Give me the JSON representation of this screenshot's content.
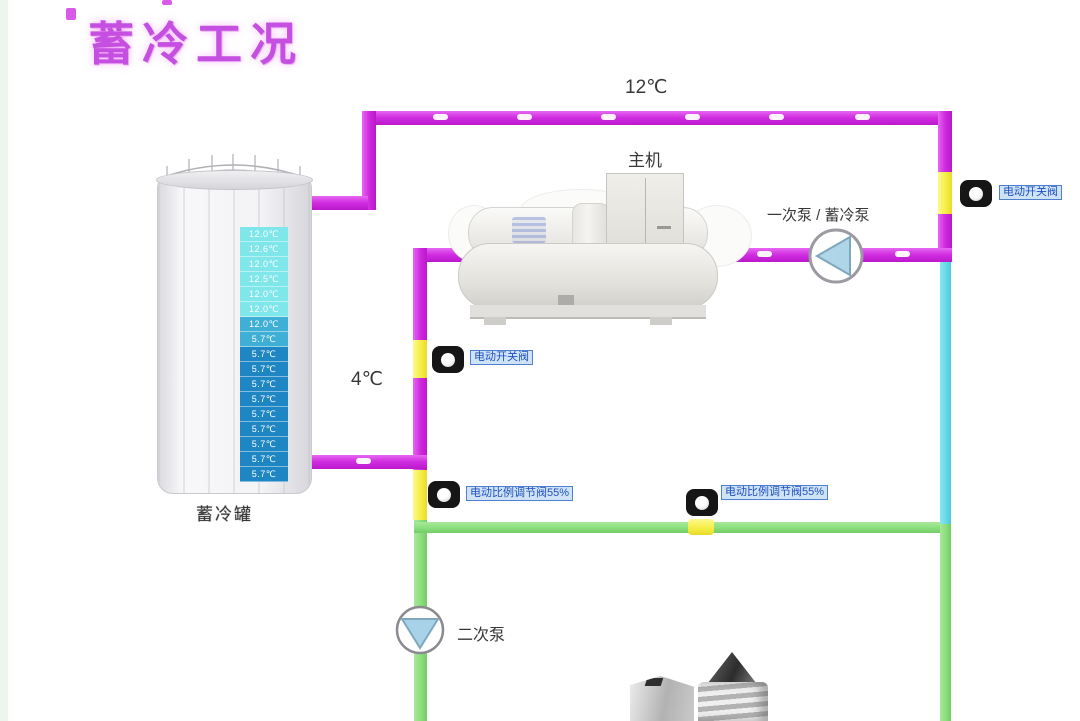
{
  "title": "蓄冷工况",
  "pipeline_labels": {
    "supply_temp": "12℃",
    "return_temp": "4℃"
  },
  "equipment": {
    "chiller_label": "主机",
    "primary_pump_label": "一次泵 / 蓄冷泵",
    "secondary_pump_label": "二次泵"
  },
  "valves": {
    "right_on_off": "电动开关阀",
    "middle_on_off": "电动开关阀",
    "left_proportional": "电动比例调节阀55%",
    "bypass_proportional": "电动比例调节阀55%"
  },
  "tank": {
    "label": "蓄冷罐",
    "readings": [
      {
        "value": "12.0℃",
        "level": "warm"
      },
      {
        "value": "12.6℃",
        "level": "warm"
      },
      {
        "value": "12.0℃",
        "level": "warm"
      },
      {
        "value": "12.5℃",
        "level": "warm"
      },
      {
        "value": "12.0℃",
        "level": "warm"
      },
      {
        "value": "12.0℃",
        "level": "warm"
      },
      {
        "value": "12.0℃",
        "level": "mid"
      },
      {
        "value": "5.7℃",
        "level": "mid"
      },
      {
        "value": "5.7℃",
        "level": "cold"
      },
      {
        "value": "5.7℃",
        "level": "cold"
      },
      {
        "value": "5.7℃",
        "level": "cold"
      },
      {
        "value": "5.7℃",
        "level": "cold"
      },
      {
        "value": "5.7℃",
        "level": "cold"
      },
      {
        "value": "5.7℃",
        "level": "cold"
      },
      {
        "value": "5.7℃",
        "level": "cold"
      },
      {
        "value": "5.7℃",
        "level": "cold"
      },
      {
        "value": "5.7℃",
        "level": "cold"
      }
    ]
  },
  "colors": {
    "hot_pipe_magenta": "#cf2bdf",
    "cold_pipe_blue": "#66d9ea",
    "chilled_pipe_green": "#8ade7c",
    "valve_segment_yellow": "#f6ee46",
    "title_magenta": "#c44fe0",
    "chip_bg": "#cfe3f6",
    "chip_border": "#4f7fd0",
    "chip_text": "#2050c0"
  }
}
